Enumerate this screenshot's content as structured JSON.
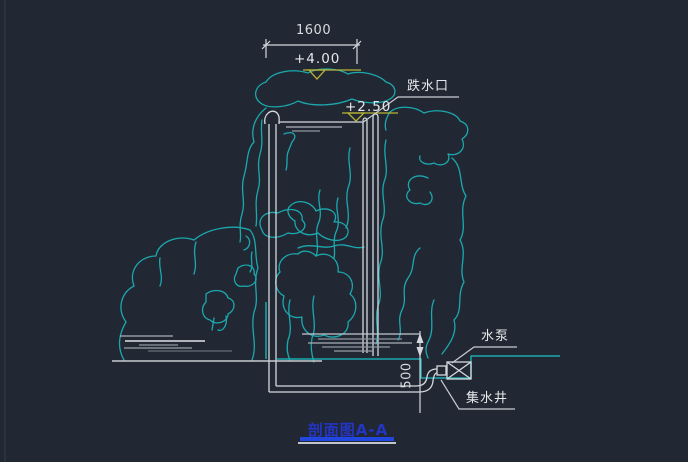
{
  "drawing": {
    "background": "#222833",
    "title": "剖面图A-A",
    "dimensions": {
      "width_top": "1600",
      "depth": "500"
    },
    "elevations": {
      "crest": "+4.00",
      "weir": "+2.50"
    },
    "labels": {
      "drop_outlet": "跌水口",
      "pump": "水泵",
      "sump_well": "集水井"
    },
    "colors": {
      "rock_line": "#1ba8ae",
      "structure_line": "#d5d9dd",
      "water_hatch": "#8e969e",
      "elevation_accent": "#b9b435",
      "title_text": "#2235c5",
      "title_underline": "#2246e0"
    }
  }
}
